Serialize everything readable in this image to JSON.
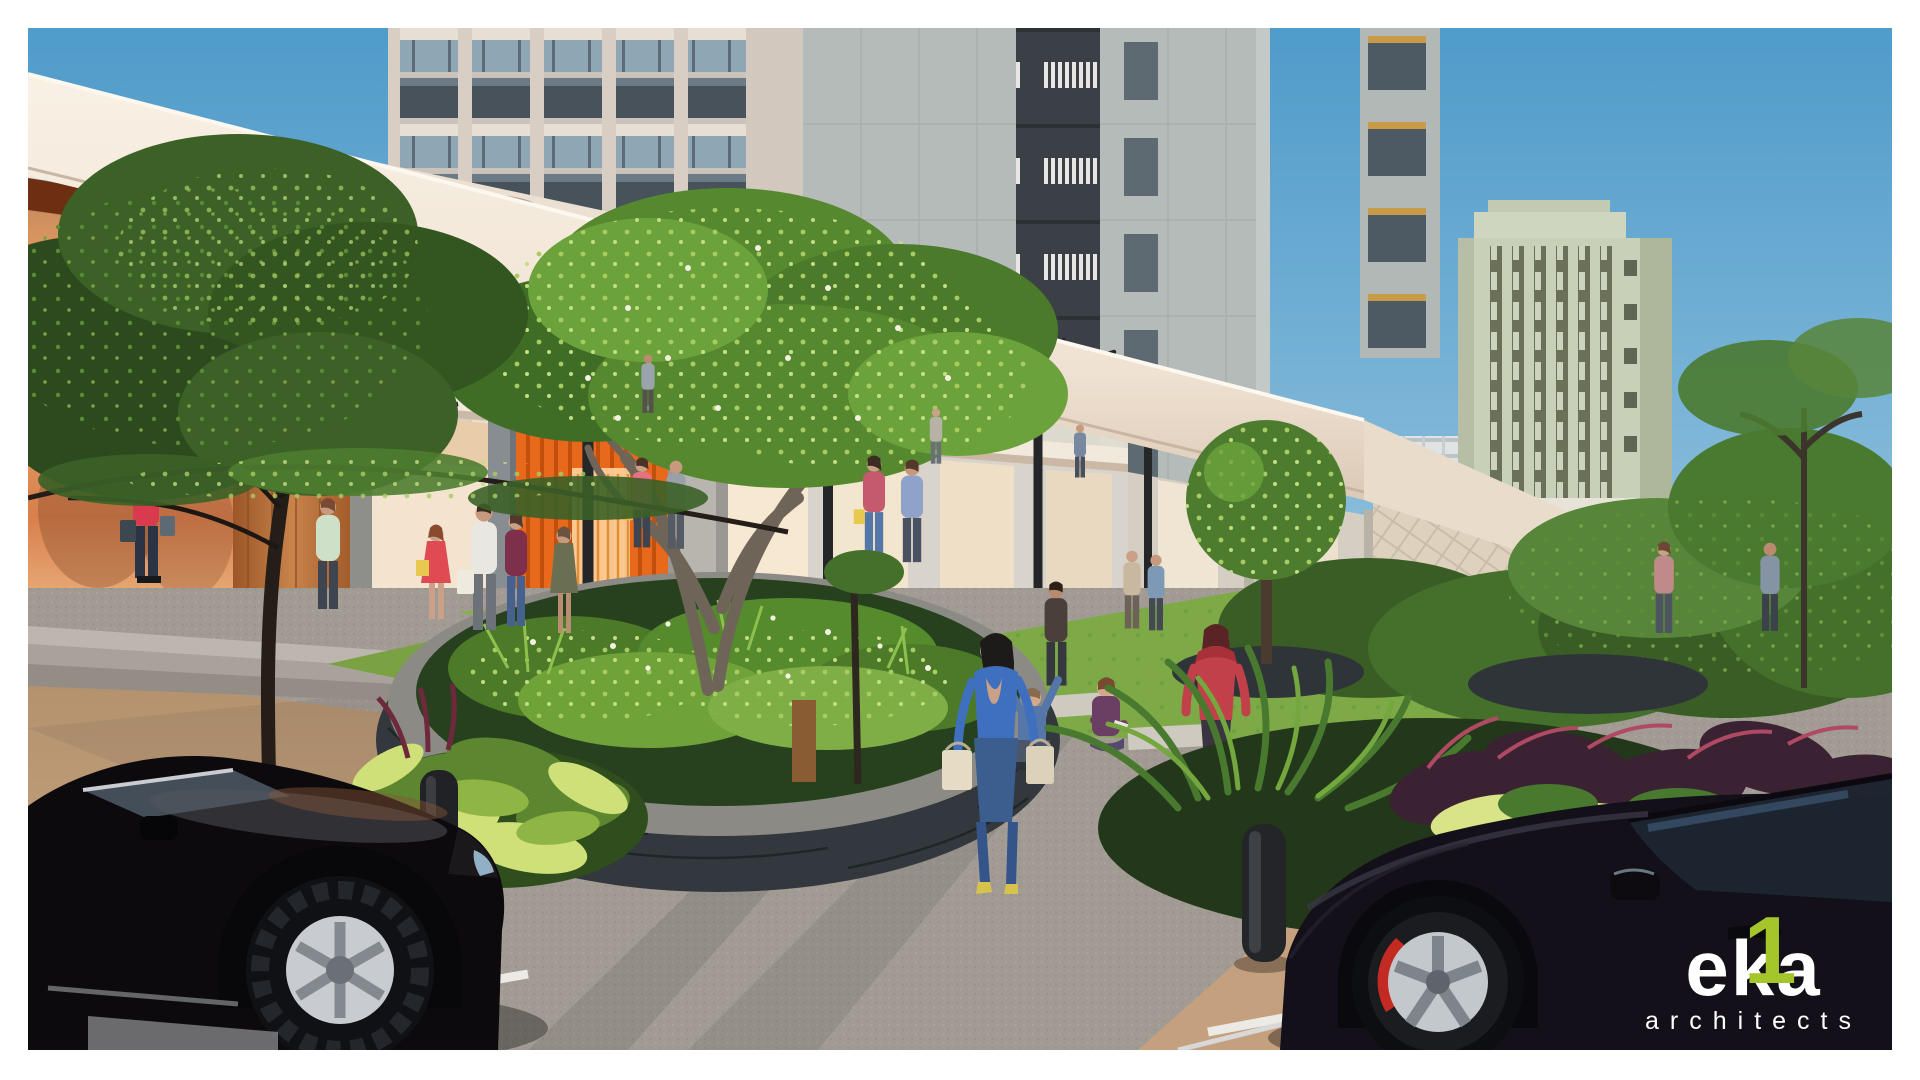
{
  "branding": {
    "logo_e": "e",
    "logo_k": "k",
    "logo_a": "a",
    "logo_one": "1",
    "logo_subtitle": "architects",
    "logo_accent_color": "#a4c62a",
    "logo_text_color": "#ffffff"
  },
  "signage": {
    "store_primary": "SPHYNX",
    "store_primary_mark": "S",
    "store_secondary": "THE SOL"
  },
  "palette": {
    "sky_top": "#4f9bca",
    "sky_horizon": "#c3dcea",
    "canopy_cream": "#f5ecdf",
    "interior_glow_orange": "#e8681c",
    "tower_grey": "#b9bfbc",
    "foliage_green": "#55882f",
    "grass_green": "#7daa47",
    "plaza_grey": "#a29b93",
    "parking_tan": "#c4a07f",
    "planter_stone": "#32383d"
  }
}
